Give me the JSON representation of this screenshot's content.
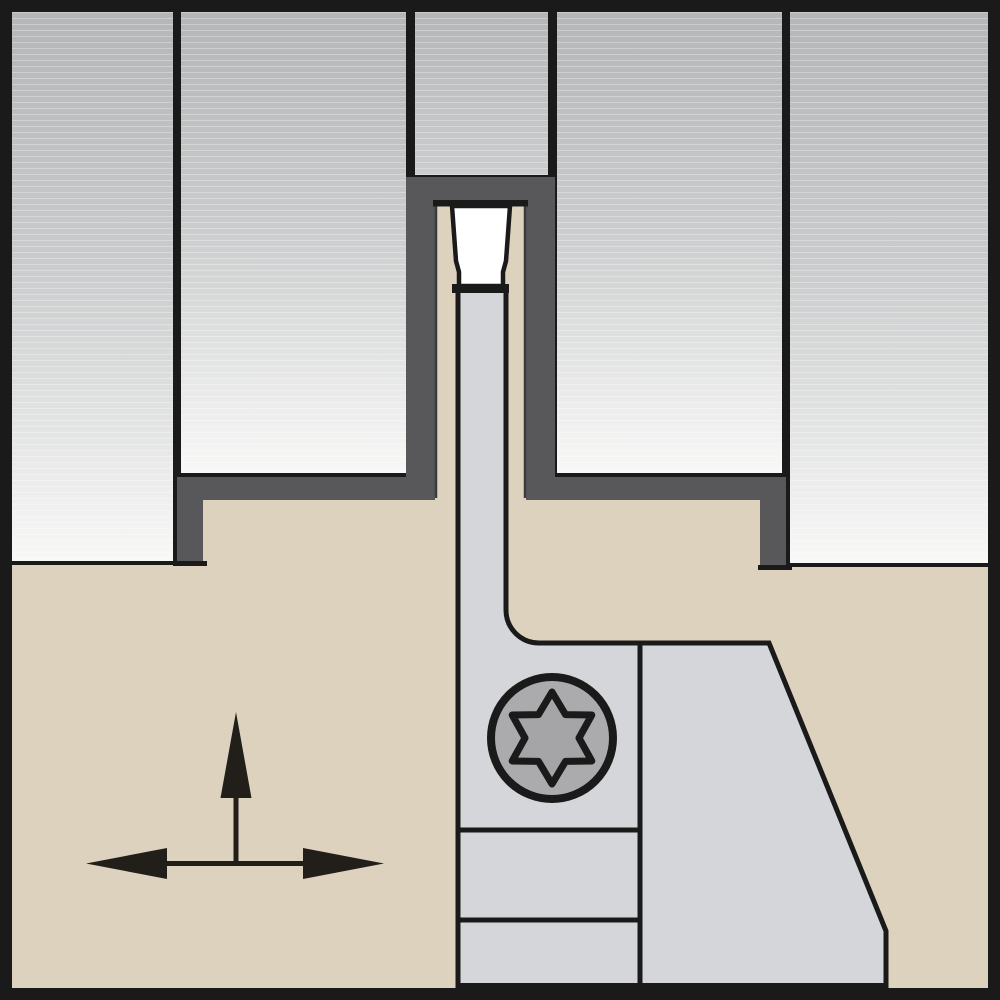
{
  "diagram": {
    "type": "technical-illustration",
    "subject": "parting and grooving toolholder shown in cross-section cutting a groove in a workpiece",
    "parts": [
      {
        "id": "workpiece-left",
        "label": "workpiece stock left section"
      },
      {
        "id": "workpiece-inner-left",
        "label": "workpiece stock inner-left section"
      },
      {
        "id": "parted-slug",
        "label": "stock slug being parted off"
      },
      {
        "id": "workpiece-inner-right",
        "label": "workpiece stock inner-right section"
      },
      {
        "id": "workpiece-right",
        "label": "workpiece stock right section"
      },
      {
        "id": "groove",
        "label": "machined groove walls and shoulders"
      },
      {
        "id": "support-blade",
        "label": "support blade of toolholder"
      },
      {
        "id": "toolholder-body",
        "label": "toolholder body block"
      },
      {
        "id": "insert",
        "label": "grooving cutting insert"
      },
      {
        "id": "clamp-screw",
        "label": "torx clamp screw head"
      },
      {
        "id": "feed-arrows",
        "label": "axial and radial feed direction arrows"
      }
    ],
    "colors": {
      "ink": "#1a1a1a",
      "tan": "#ddd2bd",
      "groove": "#58585a",
      "blade": "#d5d6d9",
      "screw_fill": "#ababae",
      "star_fill": "#a5a5a8",
      "insert_fill": "#ffffff",
      "arrow": "#221f1b",
      "wp_top": "#b4b6b8",
      "wp_mid": "#c9cbcc",
      "wp_bottom": "#f8f8f7",
      "slug_bottom": "#cbcdce",
      "edge_faint": "#3c3c3e"
    }
  }
}
